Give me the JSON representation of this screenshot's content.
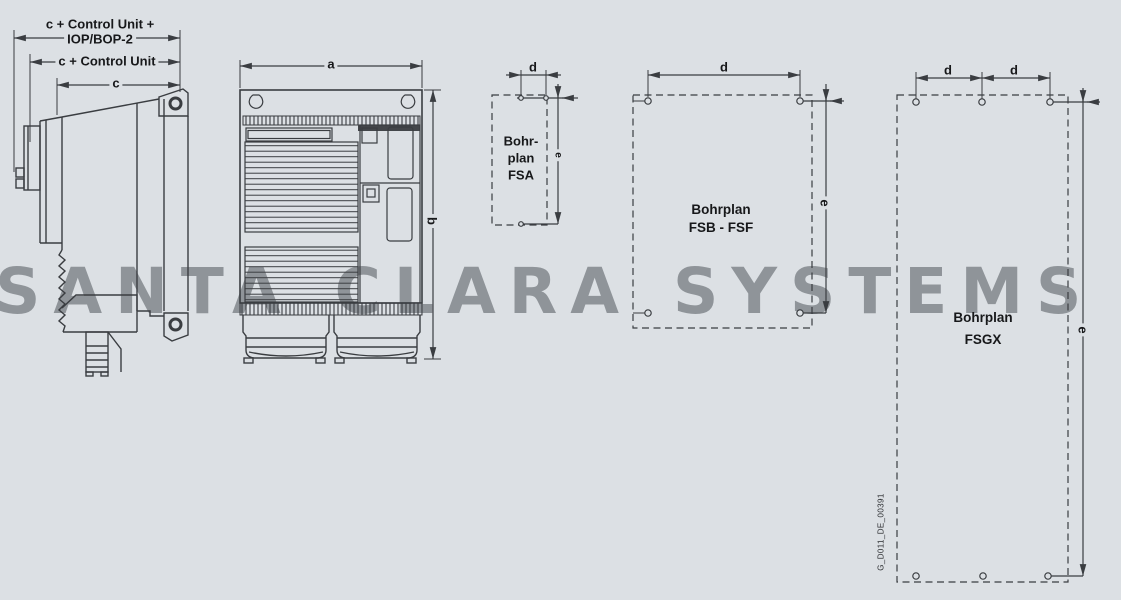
{
  "meta": {
    "type": "technical-dimension-drawing",
    "colors": {
      "background": "#dce0e4",
      "line": "#3a3d41",
      "watermark_text_color": "#8f9499",
      "label_text_color": "#17181a"
    }
  },
  "watermark": {
    "text": "SANTA CLARA SYSTEMS"
  },
  "side_view": {
    "dim_top_line1": "c + Control Unit +",
    "dim_top_line2": "IOP/BOP-2",
    "dim_mid": "c + Control Unit",
    "dim_inner": "c"
  },
  "front_view": {
    "dim_width": "a",
    "dim_height": "b"
  },
  "plans": {
    "fsa": {
      "title_line1": "Bohr-",
      "title_line2": "plan",
      "title_line3": "FSA",
      "dim_spacing": "d",
      "dim_height": "e"
    },
    "fsb": {
      "title_line1": "Bohrplan",
      "title_line2": "FSB - FSF",
      "dim_spacing": "d",
      "dim_height": "e"
    },
    "fsgx": {
      "title_line1": "Bohrplan",
      "title_line2": "FSGX",
      "dim_spacing_left": "d",
      "dim_spacing_right": "d",
      "dim_height": "e"
    }
  },
  "footer": {
    "doc_id": "G_D011_DE_00391"
  }
}
